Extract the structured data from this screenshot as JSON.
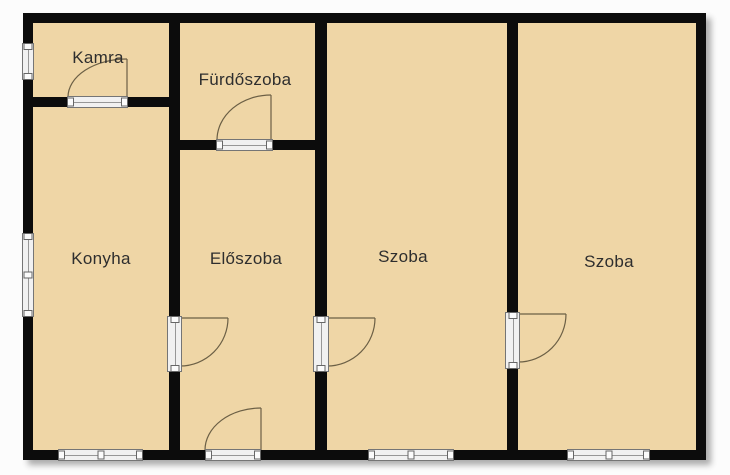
{
  "plan_title": "floor-plan",
  "rooms": [
    {
      "id": "kamra",
      "label": "Kamra"
    },
    {
      "id": "furdoszoba",
      "label": "Fürdőszoba"
    },
    {
      "id": "konyha",
      "label": "Konyha"
    },
    {
      "id": "eloszoba",
      "label": "Előszoba"
    },
    {
      "id": "szoba-1",
      "label": "Szoba"
    },
    {
      "id": "szoba-2",
      "label": "Szoba"
    }
  ],
  "colors": {
    "background": "#fcfcfc",
    "floor": "#efd6a6",
    "wall": "#0c0c0c",
    "frame": "#f1f1f1",
    "door_line": "#6b5f45",
    "label": "#2e2e2e"
  }
}
